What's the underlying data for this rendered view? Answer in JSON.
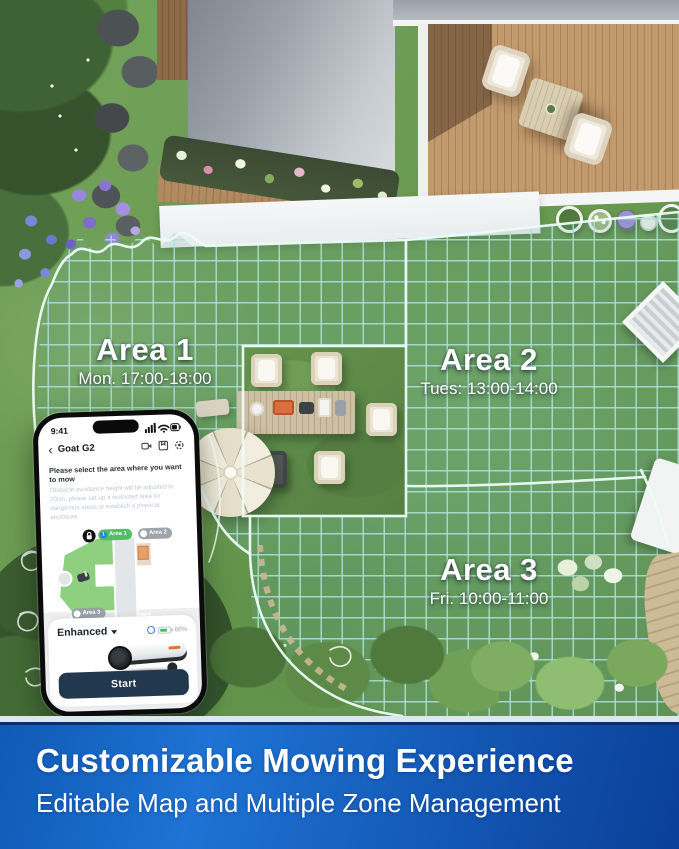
{
  "scene": {
    "areas": [
      {
        "name": "Area 1",
        "schedule": "Mon. 17:00-18:00"
      },
      {
        "name": "Area 2",
        "schedule": "Tues: 13:00-14:00"
      },
      {
        "name": "Area 3",
        "schedule": "Fri. 10:00-11:00"
      }
    ]
  },
  "phone": {
    "status_time": "9:41",
    "header": {
      "back": "‹",
      "title": "Goat G2"
    },
    "instruction": {
      "title": "Please select the area where you want to mow",
      "body": "Obstacle avoidance height will be adjusted to 20cm, please set up a restricted area for dangerous areas or establish a physical enclosure"
    },
    "map": {
      "area_badges": [
        "Area 1",
        "Area 2",
        "Area 3"
      ],
      "area1_index": "1",
      "station_label": "Station"
    },
    "controls": {
      "mode_label": "Enhanced",
      "battery_percent": "60%",
      "start_label": "Start"
    }
  },
  "banner": {
    "title": "Customizable Mowing Experience",
    "subtitle": "Editable Map and Multiple Zone Management"
  },
  "colors": {
    "banner_gradient_start": "#1e73d4",
    "banner_gradient_end": "#0a3f98",
    "grid_teal": "#8fd2ca",
    "area_selected_green": "#8ed07f",
    "start_button_navy": "#22384e",
    "accent_blue": "#2f7fe0",
    "battery_green": "#35c759"
  }
}
